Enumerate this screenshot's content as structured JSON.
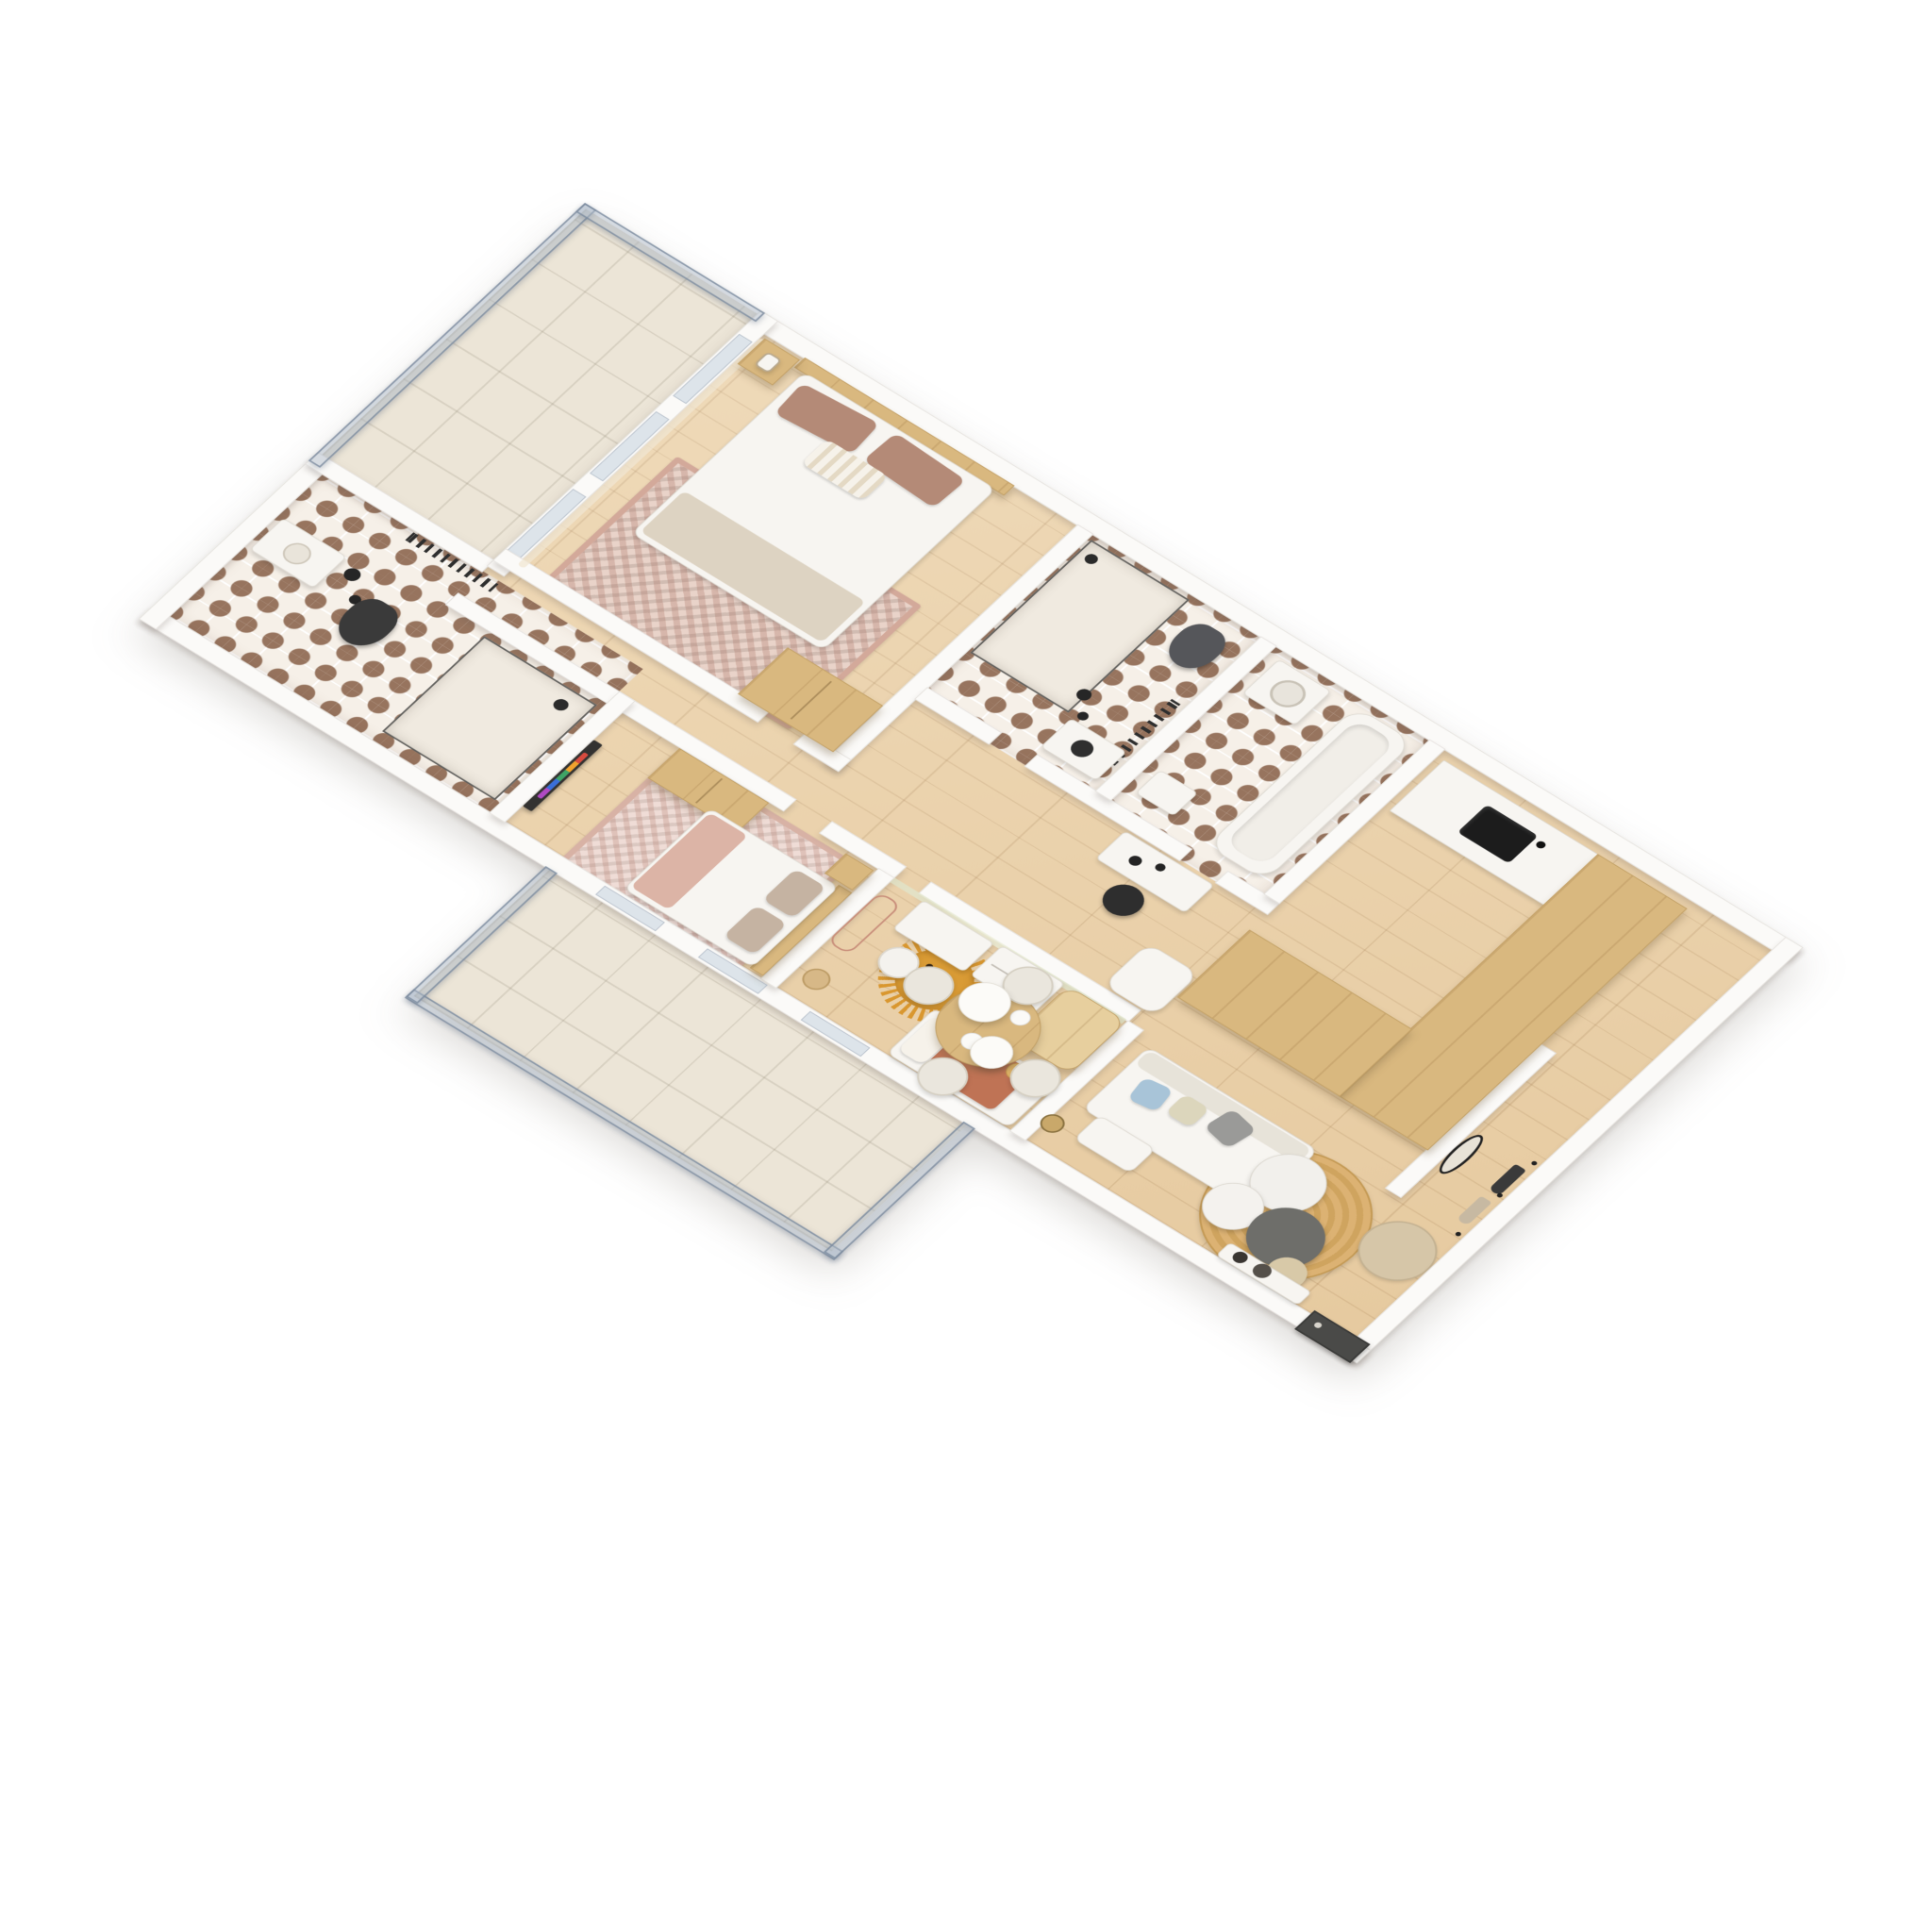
{
  "meta": {
    "type": "3d-isometric-floor-plan-render",
    "background": "#ffffff",
    "projection": "isometric birds-eye cutaway",
    "style": "scandinavian beige and white apartment"
  },
  "palette": {
    "background": "#ffffff",
    "wall": "#fbfaf8",
    "wood_floor": "#ecd2a9",
    "oak_furniture": "#d9b87f",
    "tile_base": "#f6f0e8",
    "tile_accent": "#97745e",
    "glass_railing": "#aebccd",
    "black_fixture": "#2b2b2b",
    "terracotta": "#bf7355",
    "mustard_lion": "#d9972f",
    "blush": "#e3b7ab",
    "jute": "#d2a96a",
    "sofa_white": "#f0ede6",
    "marble": "#f2f0ec"
  },
  "rooms": [
    {
      "name": "Master Bedroom",
      "floor": "light oak plank",
      "furniture": [
        "double bed with white duvet and taupe blanket",
        "wood slat headboard",
        "two brown pillows",
        "white striped accent pillow",
        "wood nightstand with picture frame",
        "vintage rose ornate rug",
        "oak wardrobe at bed foot",
        "sheer curtain at balcony window"
      ]
    },
    {
      "name": "En-suite Bathroom",
      "floor": "terracotta fan-pattern cement tile",
      "furniture": [
        "white vanity with basin",
        "matte black wall-hung toilet",
        "walk-in glass shower",
        "black towel radiator",
        "black globe pendant lamps"
      ]
    },
    {
      "name": "Bedroom 2",
      "floor": "light oak plank",
      "furniture": [
        "double bed with white duvet and blush throw",
        "wood headboard",
        "oak two-door armoire",
        "wall-mounted smart TV with colorful app row",
        "vintage ornate rug",
        "wood nightstand"
      ]
    },
    {
      "name": "Kids Room",
      "floor": "light oak plank",
      "furniture": [
        "single bed with terracotta blanket",
        "plush teddy bear",
        "mustard lion-shaped rug",
        "white desk with white chair",
        "arched oak wardrobe",
        "white dresser",
        "blush arch mirror shelf",
        "botanical wildflower wallpaper",
        "wicker basket"
      ]
    },
    {
      "name": "Bathroom 2",
      "floor": "terracotta fan-pattern cement tile",
      "furniture": [
        "walk-in glass shower",
        "gray wall-hung toilet",
        "white vanity with dark basin",
        "black towel radiator",
        "black pendant lamps"
      ]
    },
    {
      "name": "Bathroom 3 Laundry",
      "floor": "terracotta fan-pattern cement tile",
      "furniture": [
        "white bathtub",
        "washing machine",
        "compact white sink"
      ]
    },
    {
      "name": "Hallway Office Nook",
      "floor": "light oak plank",
      "furniture": [
        "white desk",
        "black shell chair",
        "two black pendant lights",
        "white lounge chair"
      ]
    },
    {
      "name": "Kitchen",
      "floor": "light oak plank",
      "furniture": [
        "U-shaped oak island counter",
        "white worktop",
        "matte black undermount sink",
        "black faucet"
      ]
    },
    {
      "name": "Living Dining",
      "floor": "light oak plank",
      "furniture": [
        "white L-shaped sofa",
        "gray blue and sand cushions",
        "round jute rug",
        "two white marble coffee tables",
        "dark gray coffee table",
        "sand side table",
        "glass tripod floor lamp",
        "round oak dining table with place settings",
        "four barrel dining chairs",
        "two white dome pendant lamps",
        "white media console with dark vases"
      ]
    },
    {
      "name": "Entry Hall",
      "floor": "light oak plank",
      "furniture": [
        "oval black-frame mirror",
        "coat hooks with black and beige coats",
        "round sand rug",
        "dark front door"
      ]
    },
    {
      "name": "Balcony 1",
      "floor": "pale stone tile",
      "furniture": [
        "frosted glass railing"
      ]
    },
    {
      "name": "Balcony 2",
      "floor": "pale stone tile",
      "furniture": [
        "frosted glass railing"
      ]
    }
  ]
}
